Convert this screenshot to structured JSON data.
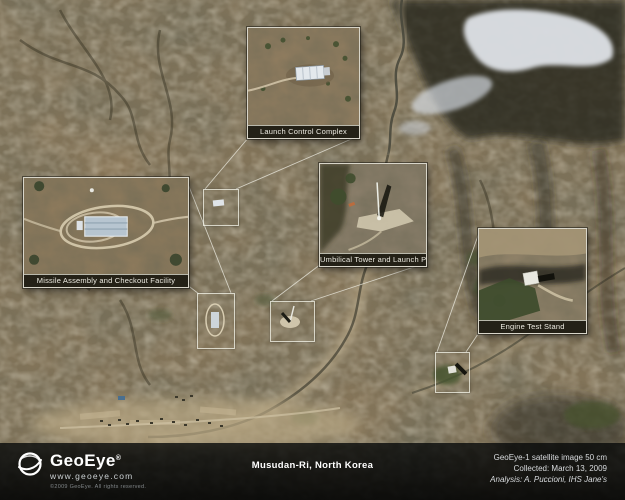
{
  "annotations": {
    "insets": [
      {
        "label": "Launch Control Complex"
      },
      {
        "label": "Missile Assembly and Checkout Facility"
      },
      {
        "label": "Umbilical Tower and Launch Pad"
      },
      {
        "label": "Engine Test Stand"
      }
    ]
  },
  "footer": {
    "brand_name": "GeoEye",
    "brand_mark": "®",
    "brand_url": "www.geoeye.com",
    "brand_copyright": "©2009 GeoEye. All rights reserved.",
    "title": "Musudan-Ri, North Korea",
    "credit_line1": "GeoEye-1 satellite image 50 cm",
    "credit_line2": "Collected: March 13, 2009",
    "credit_line3": "Analysis: A. Puccioni, IHS Jane's"
  },
  "colors": {
    "terrain_base": "#8a7759",
    "annotation_frame": "#dedcd2",
    "label_bar_bg": "#0e0e09",
    "footer_bg": "#070909",
    "snow": "#e7ebf1",
    "vegetation": "#46532f",
    "text_light": "#ffffff"
  }
}
